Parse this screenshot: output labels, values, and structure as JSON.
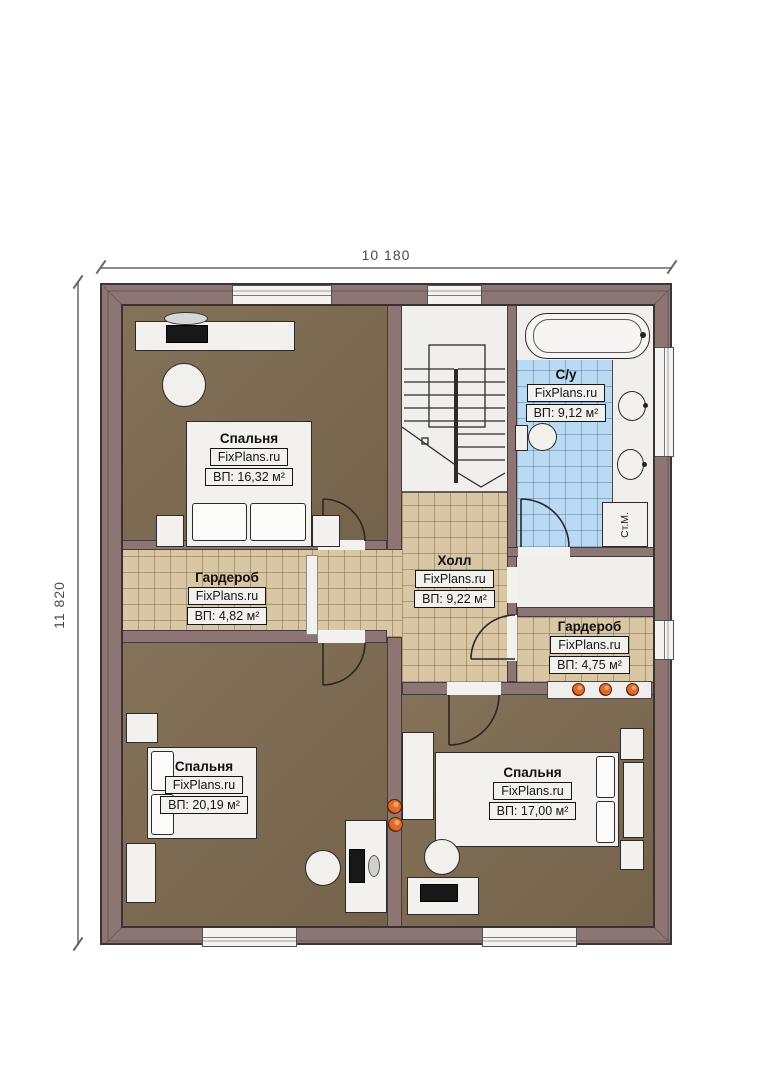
{
  "plan": {
    "dimensions": {
      "width_label": "10 180",
      "height_label": "11 820"
    },
    "brand": "FixPlans.ru",
    "rooms": [
      {
        "key": "bedroom-top-left",
        "name": "Спальня",
        "brand": "FixPlans.ru",
        "area": "ВП: 16,32 м²"
      },
      {
        "key": "bathroom",
        "name": "С/у",
        "brand": "FixPlans.ru",
        "area": "ВП: 9,12 м²"
      },
      {
        "key": "wardrobe-left",
        "name": "Гардероб",
        "brand": "FixPlans.ru",
        "area": "ВП: 4,82 м²"
      },
      {
        "key": "hall",
        "name": "Холл",
        "brand": "FixPlans.ru",
        "area": "ВП: 9,22 м²"
      },
      {
        "key": "wardrobe-right",
        "name": "Гардероб",
        "brand": "FixPlans.ru",
        "area": "ВП: 4,75 м²"
      },
      {
        "key": "bedroom-bottom-left",
        "name": "Спальня",
        "brand": "FixPlans.ru",
        "area": "ВП: 20,19 м²"
      },
      {
        "key": "bedroom-bottom-right",
        "name": "Спальня",
        "brand": "FixPlans.ru",
        "area": "ВП: 17,00 м²"
      }
    ],
    "labels": {
      "washing_machine": "Ст.М."
    },
    "colors": {
      "wall": "#8d7574",
      "floor_wood": "#7d6a50",
      "tile_beige": "#d8c6a4",
      "tile_blue": "#badaf4",
      "accent_orange": "#e06a2c"
    }
  }
}
